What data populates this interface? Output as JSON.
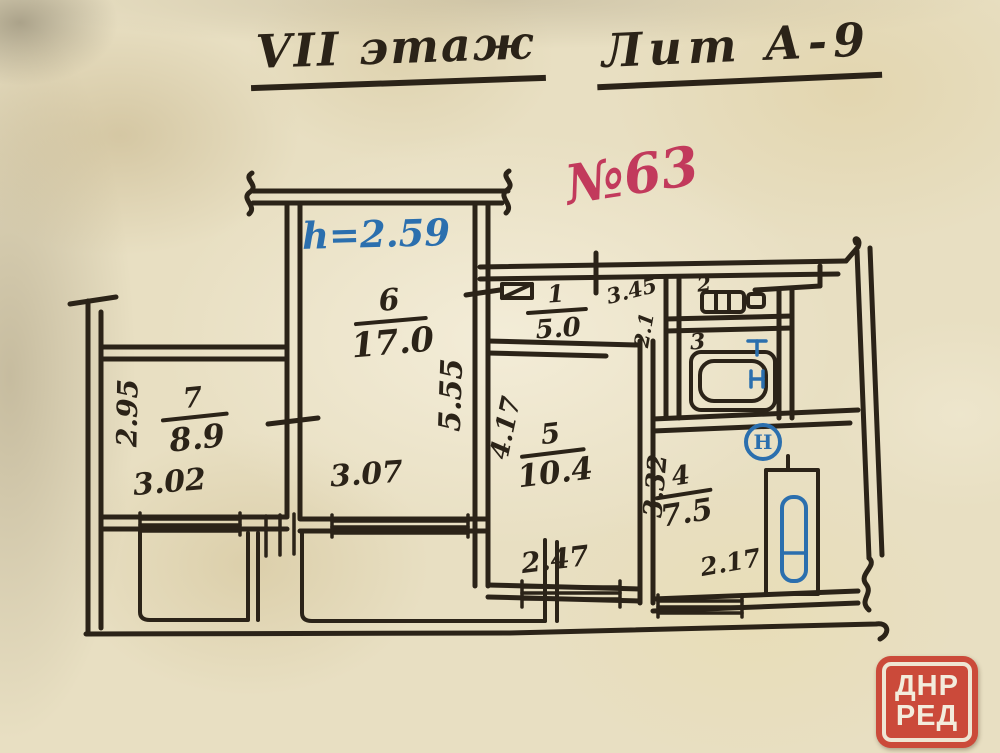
{
  "page": {
    "title_floor": "VII этаж",
    "title_liter": "Лит А-9",
    "apartment_no": "№63",
    "ceiling_height": "h=2.59"
  },
  "rooms": {
    "r1": {
      "num": "1",
      "area": "5.0"
    },
    "r2": {
      "num": "2"
    },
    "r3": {
      "num": "3"
    },
    "r4": {
      "num": "4",
      "area": "7.5"
    },
    "r5": {
      "num": "5",
      "area": "10.4"
    },
    "r6": {
      "num": "6",
      "area": "17.0"
    },
    "r7": {
      "num": "7",
      "area": "8.9"
    }
  },
  "dims": {
    "d295": "2.95",
    "d302": "3.02",
    "d307": "3.07",
    "d555": "5.55",
    "d417": "4.17",
    "d247": "2.47",
    "d345": "3.45",
    "d21": "2.1",
    "d332": "3.32",
    "d217": "2.17"
  },
  "symbols": {
    "circle_letter": "Н"
  },
  "watermark": {
    "line1": "ДНР",
    "line2": "РЕД"
  },
  "colors": {
    "ink": "#2b2318",
    "blue": "#2b6fae",
    "red_note": "#c23a5c",
    "stamp": "#cb4a3a",
    "paper": "#e8dfc2"
  }
}
